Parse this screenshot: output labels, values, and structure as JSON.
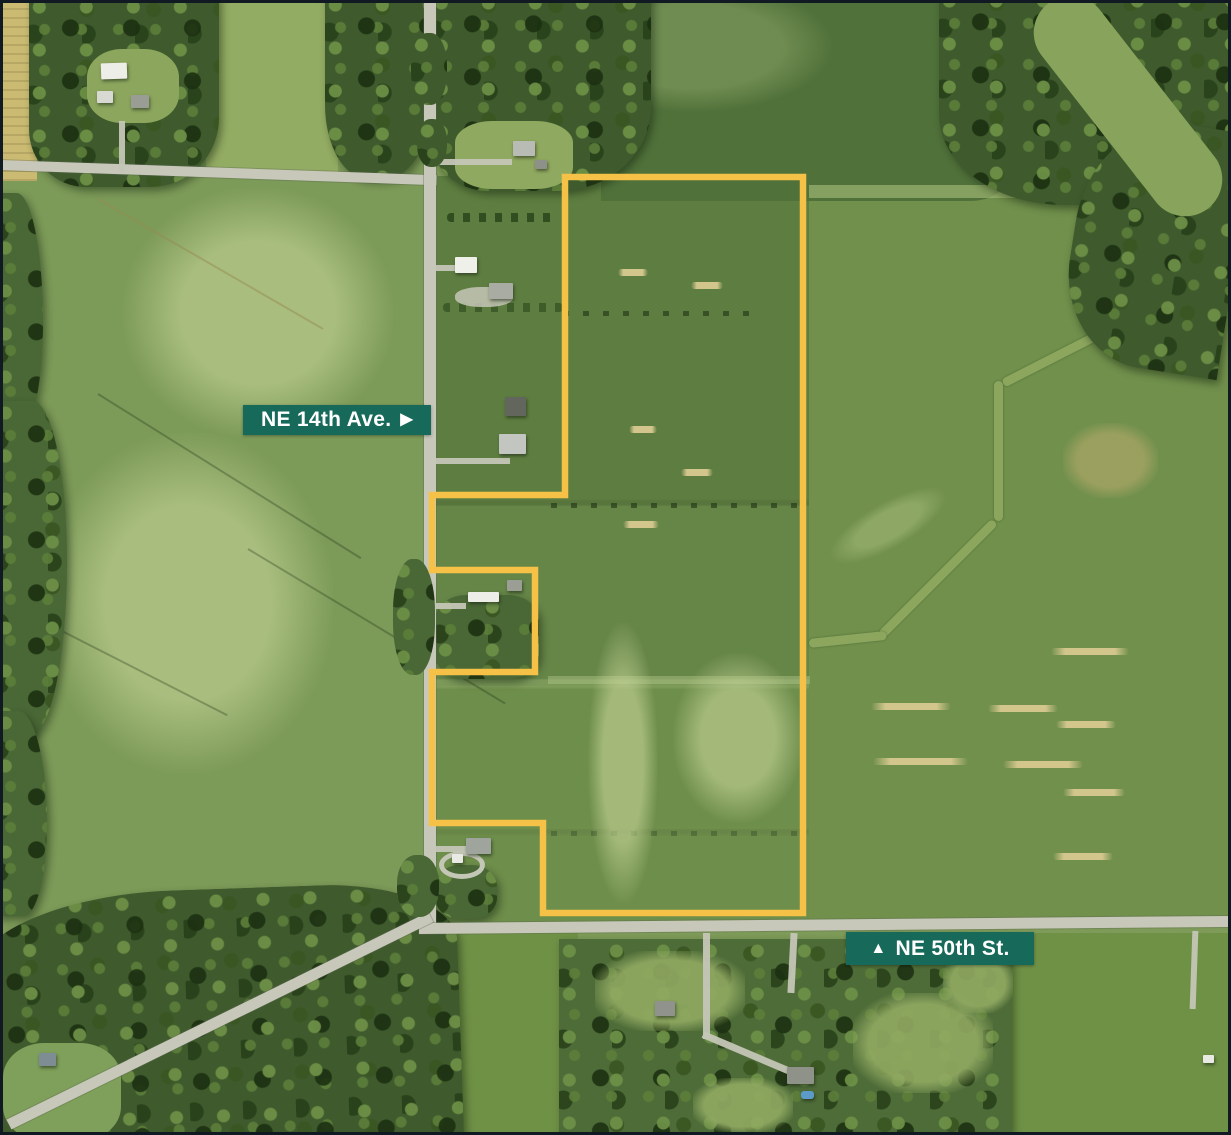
{
  "map": {
    "description": "Aerial farmland photo with outlined land parcel",
    "road_labels": [
      {
        "id": "ne14",
        "text": "NE 14th Ave.",
        "arrow_direction": "right",
        "arrow_glyph": "▶"
      },
      {
        "id": "ne50",
        "text": "NE 50th St.",
        "arrow_direction": "up",
        "arrow_glyph": "▲"
      }
    ],
    "parcel_boundary": {
      "color": "#F6C147",
      "stroke_width": "6.5",
      "points": "565,177 803,177 803,913 543,913 543,823 432,823 432,672 535,672 535,570 432,570 432,495 565,495"
    },
    "theme": {
      "badge_bg": "#17695A",
      "badge_text": "#FFFFFF",
      "frame": "#111A23",
      "road": "#C8C8BA",
      "field": "#7E9B59",
      "forest": "#3F5B2D"
    }
  }
}
